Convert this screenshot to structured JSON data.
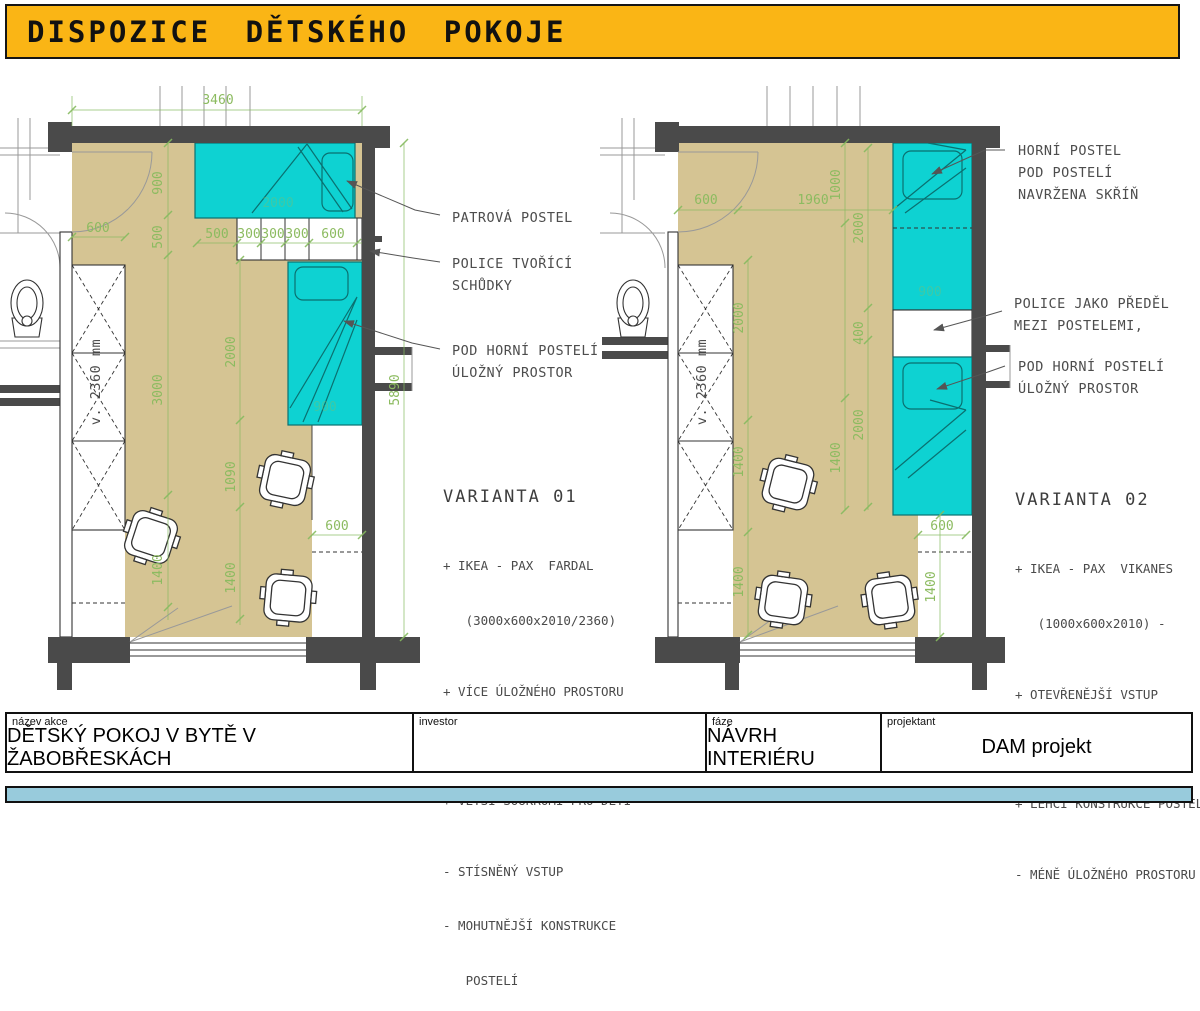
{
  "header": {
    "title": "DISPOZICE DĚTSKÉHO POKOJE"
  },
  "colors": {
    "header_yellow": "#FAB515",
    "floor_tan": "#D5C493",
    "furniture_cyan": "#0ED2D2",
    "dimension_green": "#86BB5F",
    "wall_dark": "#4A4A4A",
    "footer_blue": "#98CBDC"
  },
  "plan1": {
    "notes": [
      [
        "PATROVÁ POSTEL"
      ],
      [
        "POLICE TVOŘÍCÍ",
        "SCHŮDKY"
      ],
      [
        "POD HORNÍ POSTELÍ",
        "ÚLOŽNÝ PROSTOR"
      ]
    ],
    "dims": [
      "3460",
      "900",
      "600",
      "500",
      "500",
      "300",
      "300",
      "300",
      "600",
      "2000",
      "2000",
      "900",
      "3000",
      "1090",
      "1400",
      "1400",
      "600",
      "5890"
    ],
    "wardrobe": "v. 2360 mm"
  },
  "plan2": {
    "notes": [
      [
        "HORNÍ POSTEL",
        "POD POSTELÍ",
        "NAVRŽENA SKŘÍŇ"
      ],
      [
        "POLICE JAKO PŘEDĚL",
        "MEZI POSTELEMI,"
      ],
      [
        "POD HORNÍ POSTELÍ",
        "ÚLOŽNÝ PROSTOR"
      ]
    ],
    "dims": [
      "600",
      "1960",
      "1000",
      "2000",
      "900",
      "400",
      "2000",
      "2000",
      "1400",
      "1400",
      "600",
      "1400",
      "1400"
    ],
    "wardrobe": "v. 2360 mm"
  },
  "variant1": {
    "title": "VARIANTA 01",
    "lines": [
      "+ IKEA - PAX  FARDAL",
      "   (3000x600x2010/2360)",
      "+ VÍCE ÚLOŽNÉHO PROSTORU",
      "+ POLICE TVOŘÍCÍ SCHŮDKY",
      "+ VĚTŠÍ SOUKROMÍ PRO DĚTI",
      "- STÍSNĚNÝ VSTUP",
      "- MOHUTNĚJŠÍ KONSTRUKCE",
      "   POSTELÍ"
    ]
  },
  "variant2": {
    "title": "VARIANTA 02",
    "lines": [
      "+ IKEA - PAX  VIKANES",
      "   (1000x600x2010) -",
      "+ OTEVŘENĚJŠÍ VSTUP",
      "+ VÍCE VOLNÉHO PROSTORU",
      "+ LEHČÍ KONSTRUKCE POSTELÍ",
      "- MÉNĚ ÚLOŽNÉHO PROSTORU"
    ]
  },
  "titleblock": {
    "fields": [
      {
        "label": "název akce",
        "value": "DĚTSKÝ POKOJ V BYTĚ V ŽABOBŘESKÁCH"
      },
      {
        "label": "investor",
        "value": ""
      },
      {
        "label": "fáze",
        "value": "NÁVRH INTERIÉRU"
      },
      {
        "label": "projektant",
        "value": "DAM projekt"
      }
    ]
  }
}
